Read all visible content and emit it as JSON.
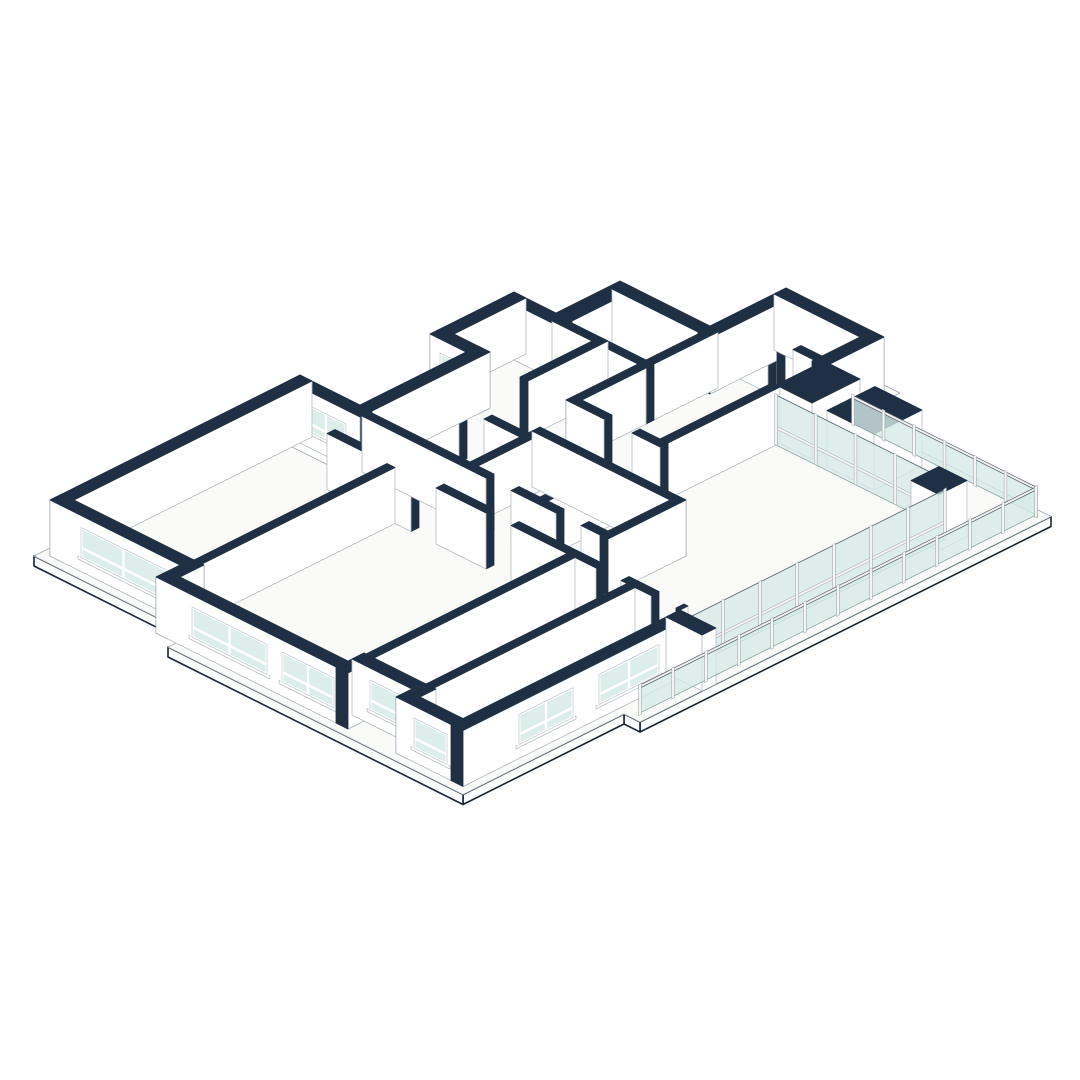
{
  "title": "Isometric cutaway floor plan drawing",
  "scene": {
    "colors": {
      "bg": "#ffffff",
      "navy": "#1f3044",
      "face": "#ffffff",
      "faceStroke": "#b8bec6",
      "slabTop": "#fafaf8",
      "slabStroke": "#a0a7ae",
      "slabEdge": "#1a2533",
      "glass": "#d7eae6",
      "glassStroke": "#93aeaa",
      "post": "#f3f4f2",
      "postStroke": "#9aa1a7",
      "rail": "#f1f2f0",
      "railStroke": "#5a646e"
    },
    "iso": {
      "ox": 620,
      "oy": 287,
      "wallH": 56,
      "slabT": 10
    },
    "slab": {
      "outline": [
        [
          46,
          42
        ],
        [
          132,
          42
        ],
        [
          132,
          -34
        ],
        [
          246,
          -34
        ],
        [
          246,
          14
        ],
        [
          445,
          14
        ],
        [
          445,
          425
        ],
        [
          429,
          425
        ],
        [
          429,
          586
        ],
        [
          134,
          586
        ],
        [
          134,
          562
        ],
        [
          -24,
          562
        ],
        [
          -24,
          324
        ],
        [
          36,
          324
        ],
        [
          36,
          206
        ],
        [
          0,
          206
        ],
        [
          0,
          106
        ],
        [
          46,
          106
        ]
      ],
      "visibleEdges": [
        [
          5,
          6
        ],
        [
          6,
          7
        ],
        [
          7,
          8
        ],
        [
          8,
          9
        ],
        [
          10,
          11
        ]
      ]
    },
    "walls": [
      {
        "id": "w1",
        "x": [
          54,
          152
        ],
        "y": [
          50,
          62
        ]
      },
      {
        "id": "w2",
        "x": [
          54,
          50
        ],
        "y": [
          50,
          124
        ]
      },
      {
        "id": "w2b",
        "x": [
          54,
          66
        ],
        "y": [
          50,
          124
        ]
      },
      {
        "id": "w3",
        "x": [
          8,
          66
        ],
        "y": [
          114,
          126
        ]
      },
      {
        "id": "w4",
        "x": [
          8,
          20
        ],
        "y": [
          114,
          198
        ]
      },
      {
        "id": "w5",
        "x": [
          8,
          56
        ],
        "y": [
          186,
          198
        ]
      },
      {
        "id": "w6",
        "x": [
          44,
          56
        ],
        "y": [
          186,
          316
        ]
      },
      {
        "id": "w7",
        "x": [
          -16,
          56
        ],
        "y": [
          304,
          316
        ]
      },
      {
        "id": "w8",
        "x": [
          -16,
          -4
        ],
        "y": [
          304,
          554
        ]
      },
      {
        "id": "w9",
        "x": [
          -16,
          126
        ],
        "y": [
          542,
          554
        ]
      },
      {
        "id": "w10",
        "x": [
          114,
          126
        ],
        "y": [
          542,
          578
        ]
      },
      {
        "id": "w11",
        "x": [
          114,
          306
        ],
        "y": [
          566,
          578
        ]
      },
      {
        "id": "w12",
        "x": [
          294,
          306
        ],
        "y": [
          550,
          578
        ]
      },
      {
        "id": "w13",
        "x": [
          294,
          366
        ],
        "y": [
          550,
          562
        ]
      },
      {
        "id": "w14",
        "x": [
          354,
          366
        ],
        "y": [
          550,
          578
        ]
      },
      {
        "id": "w15",
        "x": [
          354,
          421
        ],
        "y": [
          566,
          578
        ]
      },
      {
        "id": "w16",
        "x": [
          409,
          421
        ],
        "y": [
          349,
          578
        ]
      },
      {
        "id": "w17",
        "x": [
          140,
          152
        ],
        "y": [
          -26,
          62
        ]
      },
      {
        "id": "w18",
        "x": [
          140,
          238
        ],
        "y": [
          -26,
          -14
        ]
      },
      {
        "id": "w19",
        "x": [
          226,
          238
        ],
        "y": [
          -26,
          34
        ]
      },
      {
        "id": "w20",
        "x": [
          232,
          268
        ],
        "y": [
          28,
          76
        ],
        "kind": "block"
      },
      {
        "id": "w21",
        "x": [
          283,
          330
        ],
        "y": [
          28,
          76
        ],
        "kind": "block"
      },
      {
        "id": "w22",
        "x": [
          409,
          445
        ],
        "y": [
          349,
          363
        ],
        "kind": "block",
        "k": 1001
      },
      {
        "id": "w23",
        "x": [
          395,
          423
        ],
        "y": [
          76,
          104
        ],
        "kind": "block"
      },
      {
        "id": "w24",
        "x": [
          142,
          150
        ],
        "y": [
          52,
          124
        ]
      },
      {
        "id": "w25",
        "x": [
          56,
          150
        ],
        "y": [
          116,
          124
        ]
      },
      {
        "id": "w26",
        "x": [
          96,
          104
        ],
        "y": [
          116,
          196
        ]
      },
      {
        "id": "w27",
        "x": [
          56,
          95
        ],
        "y": [
          248,
          256
        ]
      },
      {
        "id": "w28",
        "x": [
          120,
          164
        ],
        "y": [
          248,
          256
        ]
      },
      {
        "id": "w29",
        "x": [
          56,
          140
        ],
        "y": [
          341,
          349
        ]
      },
      {
        "id": "w30",
        "x": [
          165,
          215
        ],
        "y": [
          341,
          349
        ]
      },
      {
        "id": "w31",
        "x": [
          240,
          325
        ],
        "y": [
          341,
          349
        ]
      },
      {
        "id": "w32",
        "x": [
          350,
          380
        ],
        "y": [
          341,
          349
        ]
      },
      {
        "id": "w33",
        "x": [
          405,
          409
        ],
        "y": [
          341,
          349
        ]
      },
      {
        "id": "w34",
        "x": [
          56,
          180
        ],
        "y": [
          306,
          314
        ]
      },
      {
        "id": "w35",
        "x": [
          205,
          250
        ],
        "y": [
          306,
          314
        ]
      },
      {
        "id": "w36",
        "x": [
          275,
          302
        ],
        "y": [
          306,
          314
        ]
      },
      {
        "id": "w37",
        "x": [
          156,
          302
        ],
        "y": [
          236,
          244
        ]
      },
      {
        "id": "w38",
        "x": [
          226,
          234
        ],
        "y": [
          244,
          306
        ]
      },
      {
        "id": "w39",
        "x": [
          156,
          164
        ],
        "y": [
          244,
          306
        ]
      },
      {
        "id": "w40",
        "x": [
          294,
          302
        ],
        "y": [
          236,
          314
        ]
      },
      {
        "id": "w41",
        "x": [
          116,
          124
        ],
        "y": [
          349,
          542
        ]
      },
      {
        "id": "w42",
        "x": [
          296,
          304
        ],
        "y": [
          349,
          550
        ]
      },
      {
        "id": "w43",
        "x": [
          356,
          364
        ],
        "y": [
          349,
          566
        ]
      },
      {
        "id": "w44",
        "x": [
          142,
          150
        ],
        "y": [
          124,
          196
        ]
      },
      {
        "id": "w45",
        "x": [
          142,
          180
        ],
        "y": [
          188,
          196
        ]
      },
      {
        "id": "w46",
        "x": [
          208,
          236
        ],
        "y": [
          188,
          196
        ]
      },
      {
        "id": "w47",
        "x": [
          228,
          236
        ],
        "y": [
          76,
          188
        ]
      },
      {
        "id": "w48",
        "x": [
          185,
          193
        ],
        "y": [
          -14,
          28
        ]
      },
      {
        "id": "w49",
        "x": [
          152,
          180
        ],
        "y": [
          24,
          32
        ]
      },
      {
        "id": "w50",
        "x": [
          205,
          226
        ],
        "y": [
          24,
          32
        ]
      }
    ],
    "windows": [
      {
        "wall": "w9",
        "axis": "y",
        "plane": 554,
        "a": [
          15,
          100
        ],
        "z": [
          14,
          44
        ],
        "cols": 2
      },
      {
        "wall": "w11",
        "axis": "y",
        "plane": 578,
        "a": [
          150,
          225
        ],
        "z": [
          14,
          44
        ],
        "cols": 2
      },
      {
        "wall": "w11",
        "axis": "y",
        "plane": 578,
        "a": [
          240,
          292
        ],
        "z": [
          14,
          44
        ],
        "cols": 2
      },
      {
        "wall": "w13",
        "axis": "y",
        "plane": 562,
        "a": [
          312,
          348
        ],
        "z": [
          14,
          44
        ],
        "cols": 1
      },
      {
        "wall": "w15",
        "axis": "y",
        "plane": 578,
        "a": [
          372,
          405
        ],
        "z": [
          14,
          44
        ],
        "cols": 1
      },
      {
        "wall": "w16",
        "axis": "x",
        "plane": 421,
        "a": [
          382,
          442
        ],
        "z": [
          14,
          44
        ],
        "cols": 2
      },
      {
        "wall": "w16",
        "axis": "x",
        "plane": 421,
        "a": [
          468,
          522
        ],
        "z": [
          14,
          44
        ],
        "cols": 2
      },
      {
        "wall": "w5",
        "axis": "y",
        "plane": 198,
        "a": [
          18,
          48
        ],
        "z": [
          16,
          42
        ],
        "cols": 1
      },
      {
        "wall": "w7",
        "axis": "y",
        "plane": 316,
        "a": [
          2,
          42
        ],
        "z": [
          16,
          42
        ],
        "cols": 2
      }
    ],
    "glassWalls": [
      {
        "id": "curtain-ne",
        "axis": "x",
        "fixed": 80,
        "a": [
          236,
          395
        ],
        "h": 50,
        "panels": 4,
        "k": 475
      },
      {
        "id": "curtain-se",
        "axis": "y",
        "fixed": 415,
        "a": [
          90,
          349
        ],
        "h": 50,
        "panels": 7,
        "k": 764
      }
    ],
    "balustrades": [
      {
        "id": "balustrade-ne",
        "axis": "x",
        "fixed": 22,
        "a": [
          255,
          438
        ],
        "h": 30,
        "panels": 6,
        "k": 460
      },
      {
        "id": "balustrade-se",
        "axis": "y",
        "fixed": 438,
        "a": [
          22,
          418
        ],
        "h": 30,
        "panels": 12,
        "k": 1002
      }
    ]
  }
}
